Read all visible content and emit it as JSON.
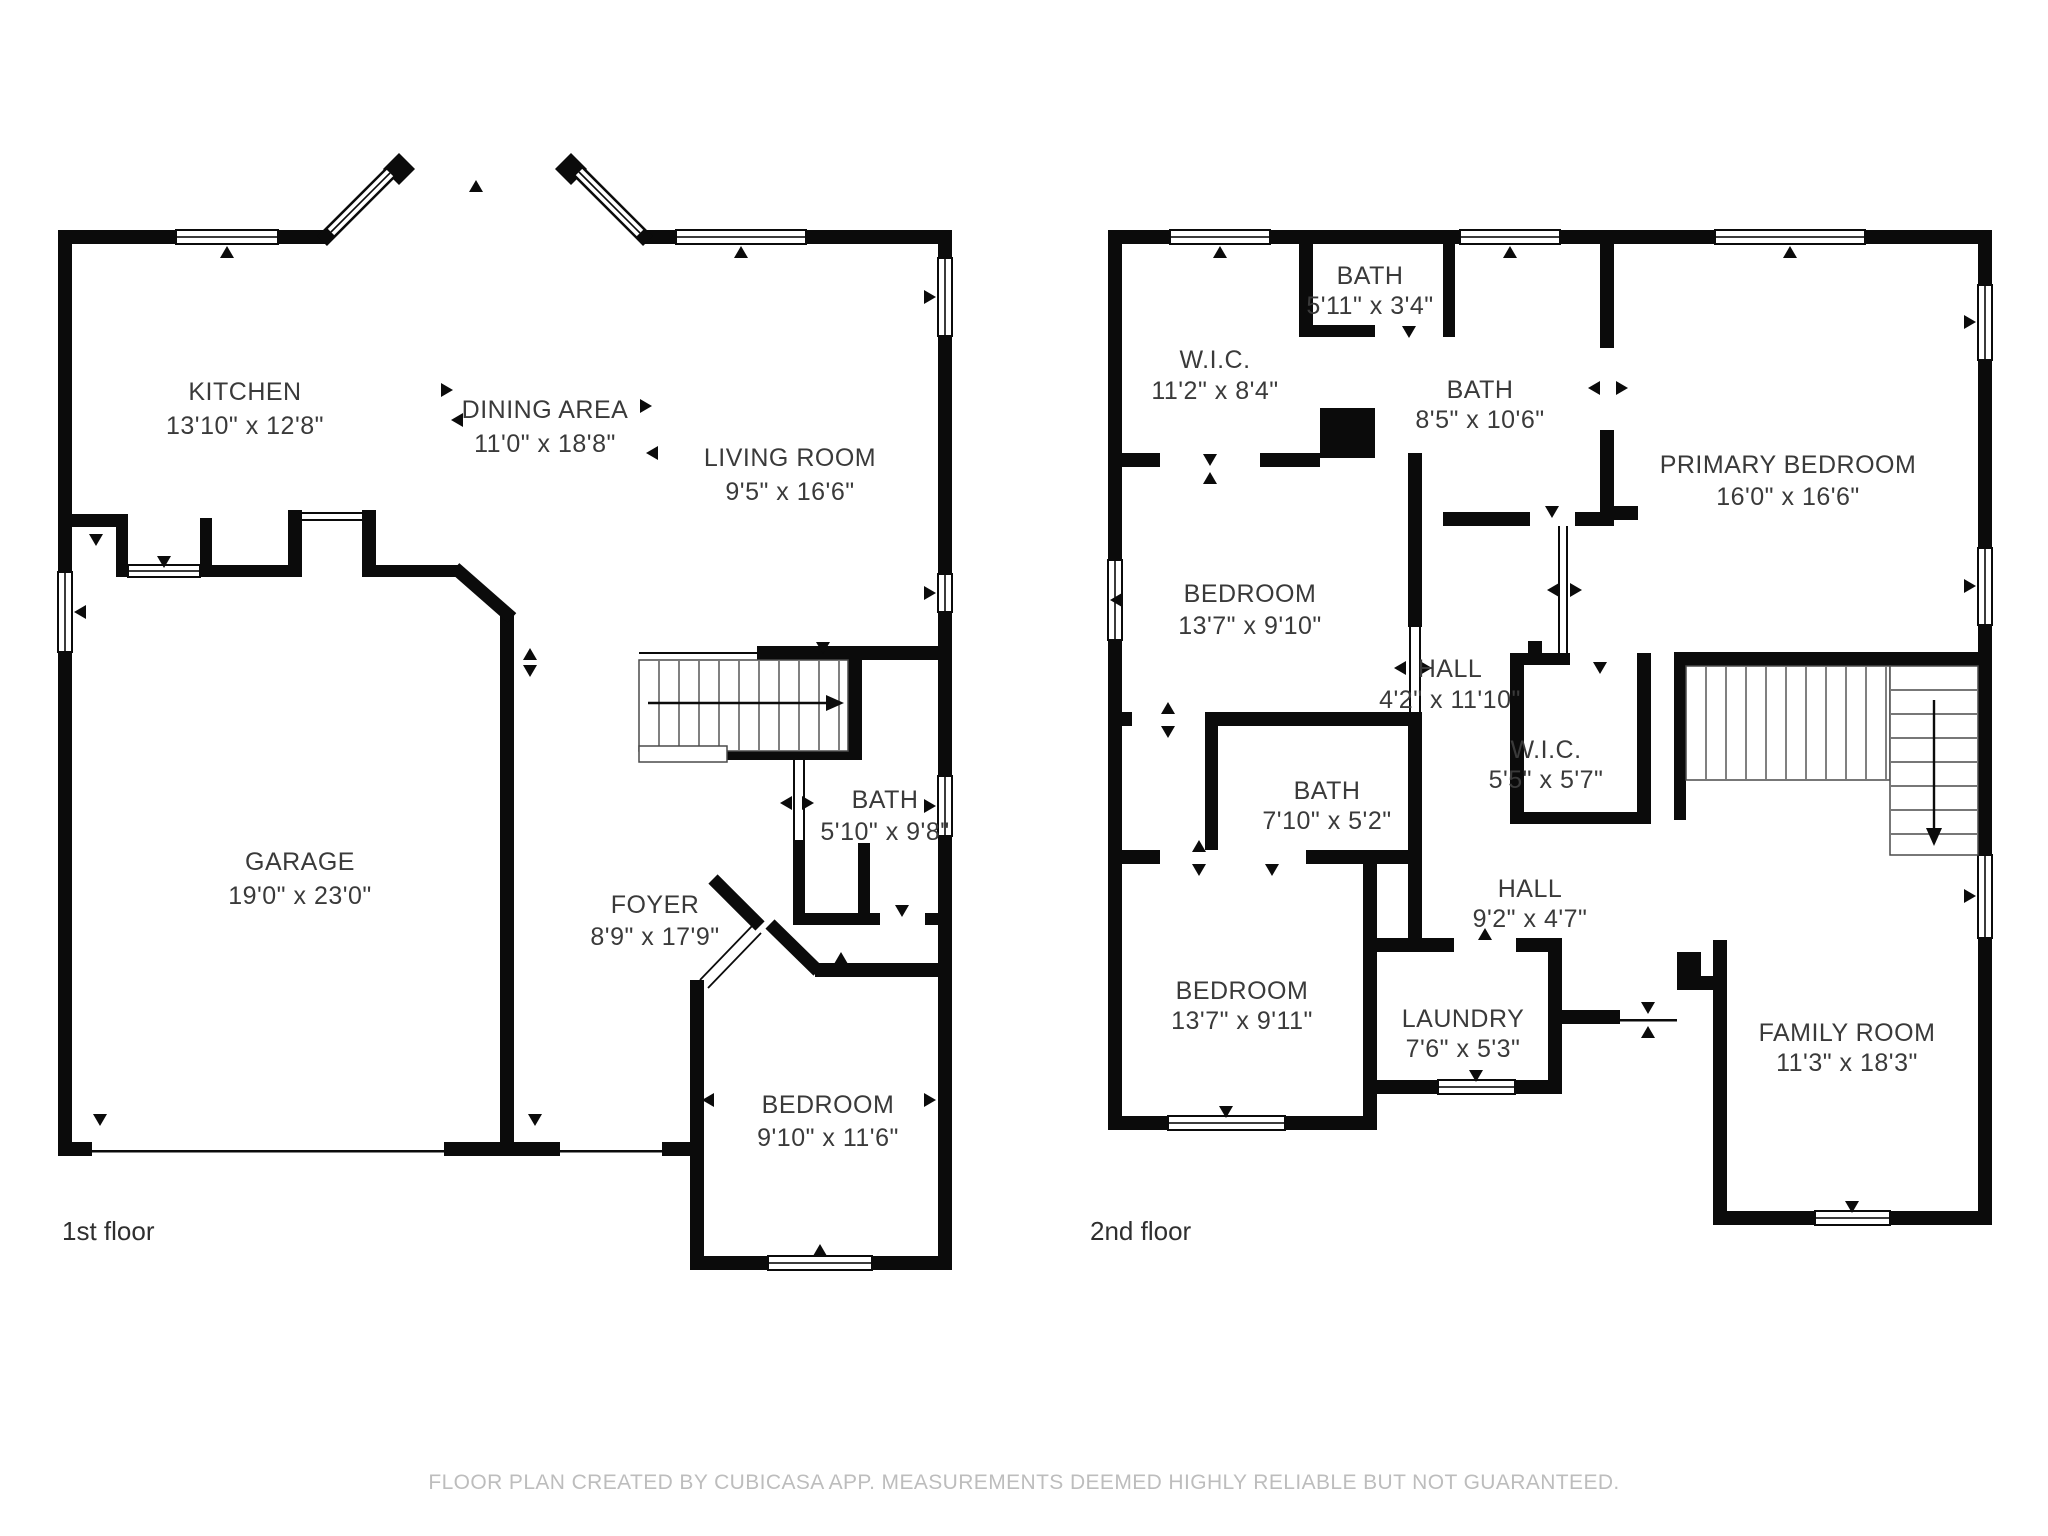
{
  "colors": {
    "wall": "#0b0b0b",
    "background": "#ffffff",
    "room_text": "#3a3a3a",
    "floor_label_text": "#2f2f2f",
    "disclaimer_text": "#bdbdbd"
  },
  "floors": [
    {
      "label": "1st floor",
      "rooms": [
        {
          "id": "kitchen",
          "name": "KITCHEN",
          "dims": "13'10\" x 12'8\""
        },
        {
          "id": "dining-area",
          "name": "DINING AREA",
          "dims": "11'0\" x 18'8\""
        },
        {
          "id": "living-room",
          "name": "LIVING ROOM",
          "dims": "9'5\" x 16'6\""
        },
        {
          "id": "garage",
          "name": "GARAGE",
          "dims": "19'0\" x 23'0\""
        },
        {
          "id": "foyer",
          "name": "FOYER",
          "dims": "8'9\" x 17'9\""
        },
        {
          "id": "bath",
          "name": "BATH",
          "dims": "5'10\" x 9'8\""
        },
        {
          "id": "bedroom",
          "name": "BEDROOM",
          "dims": "9'10\" x 11'6\""
        }
      ]
    },
    {
      "label": "2nd floor",
      "rooms": [
        {
          "id": "bath-top",
          "name": "BATH",
          "dims": "5'11\" x 3'4\""
        },
        {
          "id": "wic-left",
          "name": "W.I.C.",
          "dims": "11'2\" x 8'4\""
        },
        {
          "id": "bath-upper",
          "name": "BATH",
          "dims": "8'5\" x 10'6\""
        },
        {
          "id": "primary-bedroom",
          "name": "PRIMARY BEDROOM",
          "dims": "16'0\" x 16'6\""
        },
        {
          "id": "bedroom-a",
          "name": "BEDROOM",
          "dims": "13'7\" x 9'10\""
        },
        {
          "id": "hall-upper",
          "name": "HALL",
          "dims": "4'2\" x 11'10\""
        },
        {
          "id": "wic-small",
          "name": "W.I.C.",
          "dims": "5'5\" x 5'7\""
        },
        {
          "id": "bath-middle",
          "name": "BATH",
          "dims": "7'10\" x 5'2\""
        },
        {
          "id": "hall-lower",
          "name": "HALL",
          "dims": "9'2\" x 4'7\""
        },
        {
          "id": "bedroom-b",
          "name": "BEDROOM",
          "dims": "13'7\" x 9'11\""
        },
        {
          "id": "laundry",
          "name": "LAUNDRY",
          "dims": "7'6\" x 5'3\""
        },
        {
          "id": "family-room",
          "name": "FAMILY ROOM",
          "dims": "11'3\" x 18'3\""
        }
      ]
    }
  ],
  "footer": {
    "disclaimer": "FLOOR PLAN CREATED BY CUBICASA APP. MEASUREMENTS DEEMED HIGHLY RELIABLE BUT NOT GUARANTEED."
  }
}
